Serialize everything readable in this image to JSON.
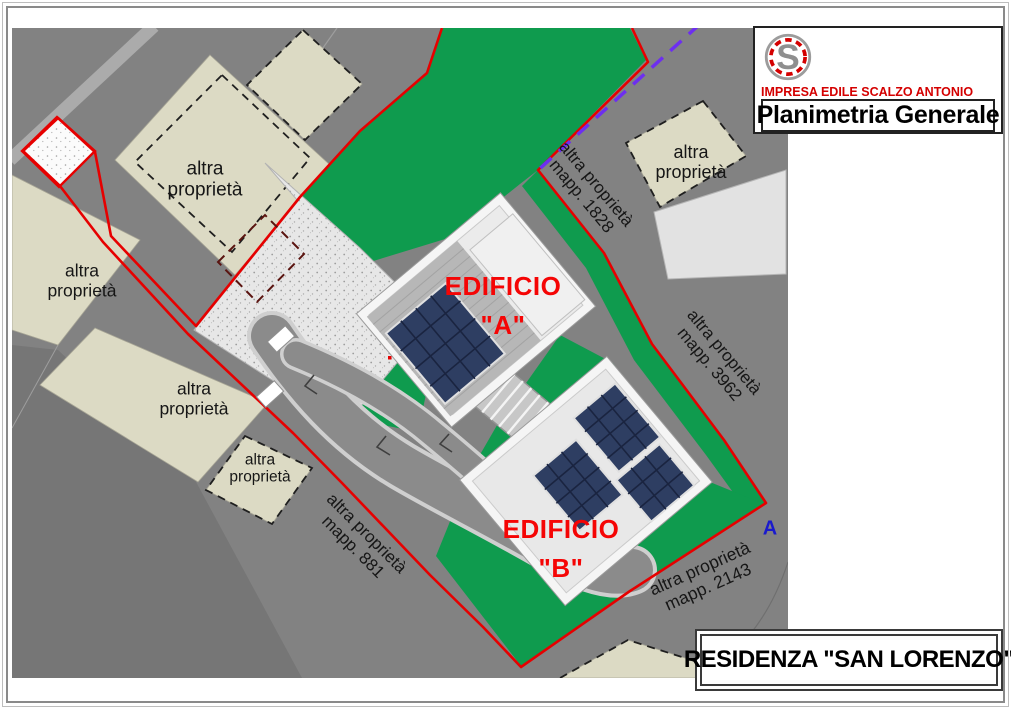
{
  "title_block": {
    "company": "IMPRESA EDILE SCALZO ANTONIO",
    "drawing_title": "Planimetria Generale",
    "logo_letter": "S"
  },
  "project_box": {
    "title": "RESIDENZA \"SAN LORENZO\""
  },
  "map": {
    "parcels": [
      {
        "label": "altra proprietà",
        "mapp": ""
      },
      {
        "label": "altra proprietà",
        "mapp": ""
      },
      {
        "label": "altra proprietà",
        "mapp": ""
      },
      {
        "label": "altra proprietà",
        "mapp": ""
      },
      {
        "label": "altra proprietà",
        "mapp": ""
      },
      {
        "label": "altra proprietà",
        "mapp": "mapp. 1828"
      },
      {
        "label": "altra proprietà",
        "mapp": "mapp. 3962"
      },
      {
        "label": "altra proprietà",
        "mapp": "mapp. 881"
      },
      {
        "label": "altra proprietà",
        "mapp": "mapp. 2143"
      }
    ],
    "buildings": [
      {
        "name": "EDIFICIO",
        "unit": "\"A\""
      },
      {
        "name": "EDIFICIO",
        "unit": "\"B\""
      }
    ],
    "section_marker": "A"
  },
  "colors": {
    "green": "#0f9b4e",
    "red": "#e60000",
    "purple": "#6d2ef0",
    "panel": "#2e3e62",
    "panel_line": "#1a2440",
    "beige": "#dcdac4",
    "road": "#828282",
    "label_red": "#f50505",
    "marker_blue": "#1a1acd",
    "logo_red": "#d40000"
  }
}
